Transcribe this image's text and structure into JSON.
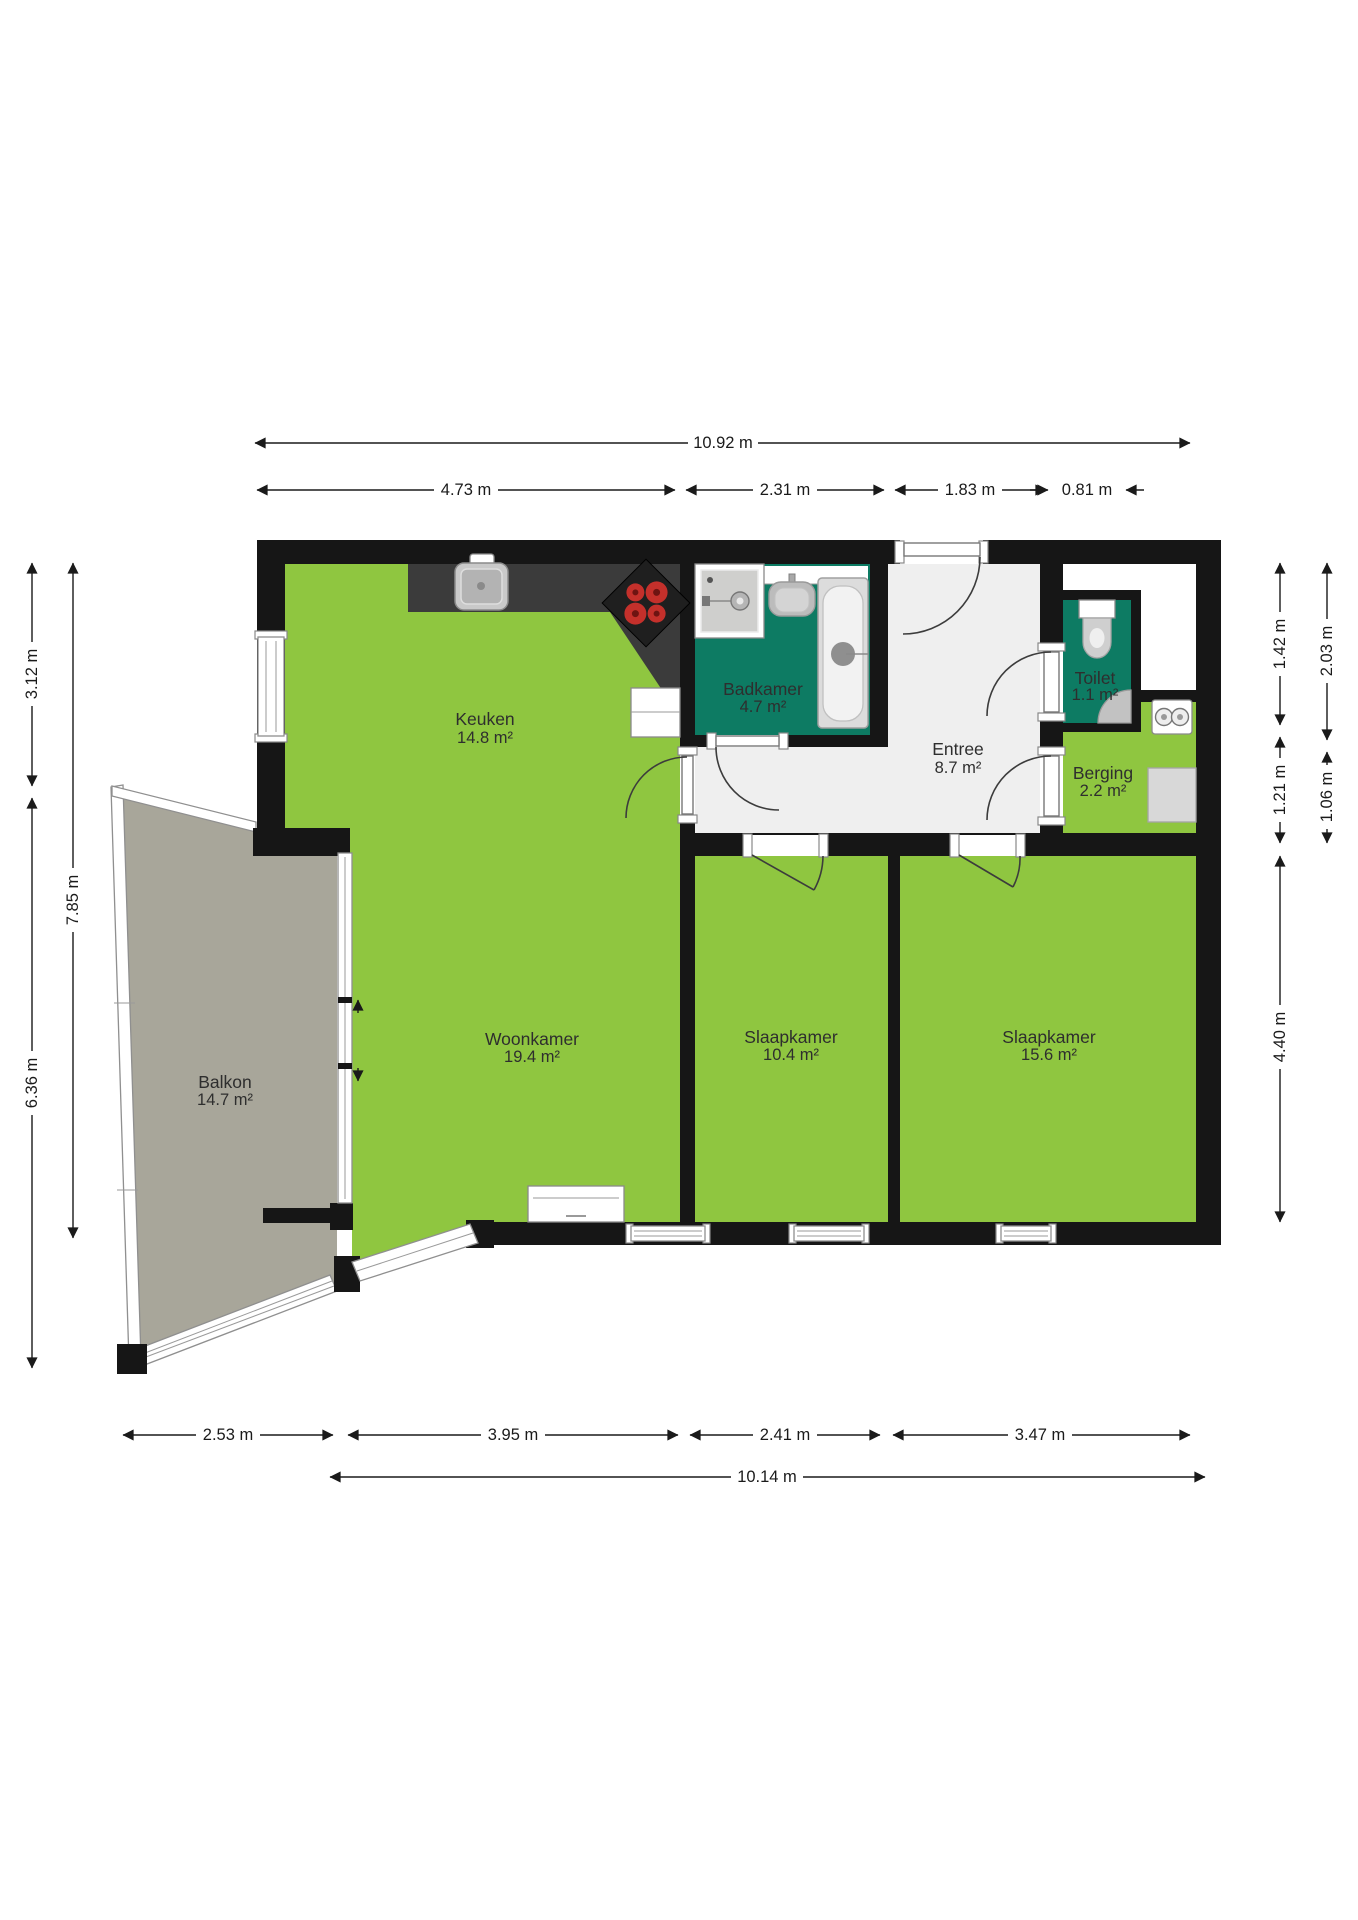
{
  "rooms": [
    {
      "id": "keuken",
      "label": "Keuken",
      "area": "14.8 m²"
    },
    {
      "id": "badkamer",
      "label": "Badkamer",
      "area": "4.7 m²"
    },
    {
      "id": "entree",
      "label": "Entree",
      "area": "8.7 m²"
    },
    {
      "id": "toilet",
      "label": "Toilet",
      "area": "1.1 m²"
    },
    {
      "id": "berging",
      "label": "Berging",
      "area": "2.2 m²"
    },
    {
      "id": "woonkamer",
      "label": "Woonkamer",
      "area": "19.4 m²"
    },
    {
      "id": "slaapkamer-1",
      "label": "Slaapkamer",
      "area": "10.4 m²"
    },
    {
      "id": "slaapkamer-2",
      "label": "Slaapkamer",
      "area": "15.6 m²"
    },
    {
      "id": "balkon",
      "label": "Balkon",
      "area": "14.7 m²"
    }
  ],
  "dimensions": {
    "top": {
      "total": "10.92 m",
      "segments": [
        "4.73 m",
        "2.31 m",
        "1.83 m",
        "0.81 m"
      ]
    },
    "left": {
      "inner_top": "3.12 m",
      "inner_bottom": "6.36 m",
      "outer": "7.85 m"
    },
    "right": {
      "inner": [
        "1.42 m",
        "1.21 m",
        "4.40 m"
      ],
      "outer": [
        "2.03 m",
        "1.06 m"
      ]
    },
    "bottom": {
      "segments": [
        "2.53 m",
        "3.95 m",
        "2.41 m",
        "3.47 m"
      ],
      "total": "10.14 m"
    }
  },
  "colors": {
    "room_green": "#8fc640",
    "wet_room": "#0d7b63",
    "balcony": "#a8a69a",
    "entry": "#efefef",
    "wall": "#161616",
    "counter": "#3b3b3b",
    "burner_red": "#c4302b"
  }
}
